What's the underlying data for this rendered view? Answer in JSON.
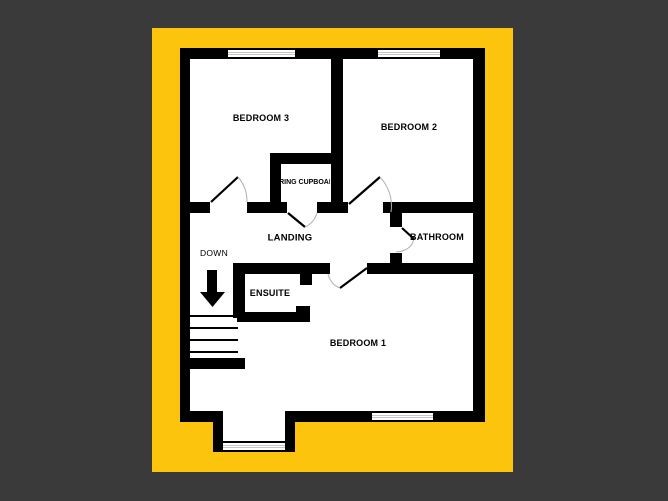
{
  "figure": {
    "kind": "floor-plan",
    "colors": {
      "page_background": "#3a3a3a",
      "mat": "#fdc40d",
      "wall": "#000000",
      "floor": "#ffffff",
      "door_arc": "#b0b0b0",
      "window_pane": "#8f8f8f"
    }
  },
  "rooms": {
    "bedroom3": {
      "label": "BEDROOM 3"
    },
    "bedroom2": {
      "label": "BEDROOM 2"
    },
    "bedroom1": {
      "label": "BEDROOM 1"
    },
    "landing": {
      "label": "LANDING"
    },
    "bathroom": {
      "label": "BATHROOM"
    },
    "ensuite": {
      "label": "ENSUITE"
    },
    "airing_cupboard": {
      "label": "AIRING CUPBOARD"
    }
  },
  "stairs": {
    "direction_label": "DOWN"
  }
}
